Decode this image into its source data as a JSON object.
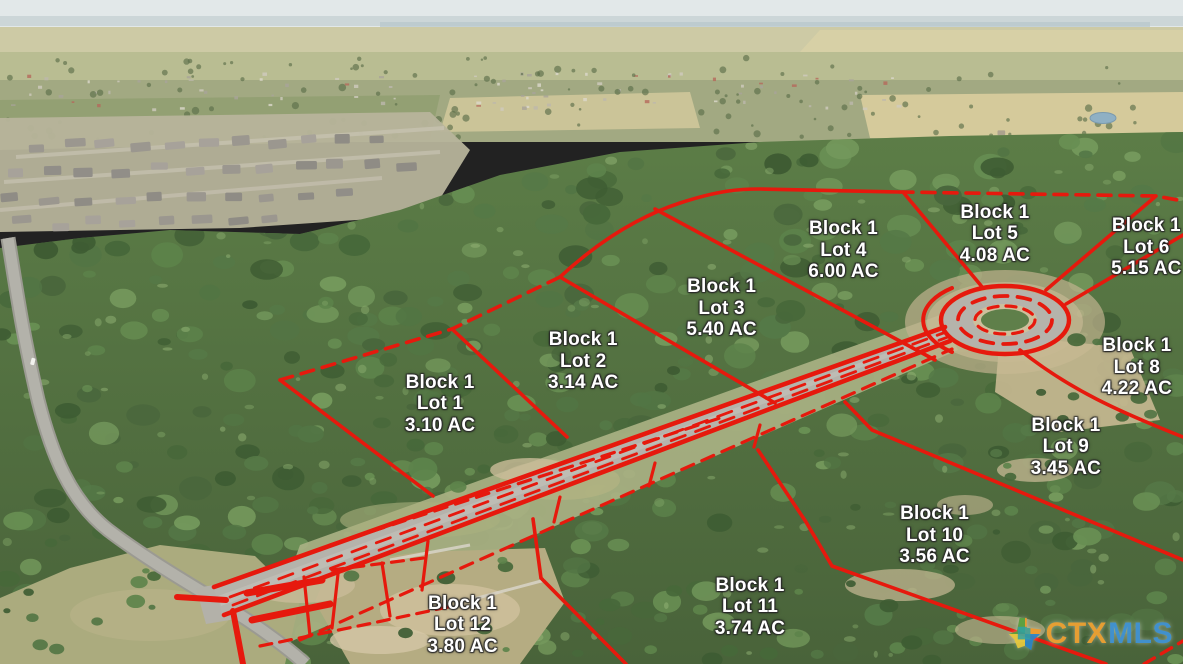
{
  "colors": {
    "overlay_red": "#e6190d",
    "label_text": "#ffffff",
    "watermark_ctx": "#f0a233",
    "watermark_mls": "#4193d6"
  },
  "watermark": {
    "prefix": "CTX",
    "suffix": "MLS"
  },
  "lots": [
    {
      "block": "Block 1",
      "lot": "Lot 1",
      "area": "3.10 AC",
      "x": 37.2,
      "y": 60.8
    },
    {
      "block": "Block 1",
      "lot": "Lot 2",
      "area": "3.14 AC",
      "x": 49.3,
      "y": 54.4
    },
    {
      "block": "Block 1",
      "lot": "Lot 3",
      "area": "5.40 AC",
      "x": 61.0,
      "y": 46.4
    },
    {
      "block": "Block 1",
      "lot": "Lot 4",
      "area": "6.00 AC",
      "x": 71.3,
      "y": 37.7
    },
    {
      "block": "Block 1",
      "lot": "Lot 5",
      "area": "4.08 AC",
      "x": 84.1,
      "y": 35.2
    },
    {
      "block": "Block 1",
      "lot": "Lot 6",
      "area": "5.15 AC",
      "x": 96.9,
      "y": 37.2
    },
    {
      "block": "Block 1",
      "lot": "Lot 8",
      "area": "4.22 AC",
      "x": 96.1,
      "y": 55.3
    },
    {
      "block": "Block 1",
      "lot": "Lot 9",
      "area": "3.45 AC",
      "x": 90.1,
      "y": 67.3
    },
    {
      "block": "Block 1",
      "lot": "Lot 10",
      "area": "3.56 AC",
      "x": 79.0,
      "y": 80.6
    },
    {
      "block": "Block 1",
      "lot": "Lot 11",
      "area": "3.74 AC",
      "x": 63.4,
      "y": 91.4
    },
    {
      "block": "Block 1",
      "lot": "Lot 12",
      "area": "3.80 AC",
      "x": 39.1,
      "y": 94.1
    }
  ]
}
